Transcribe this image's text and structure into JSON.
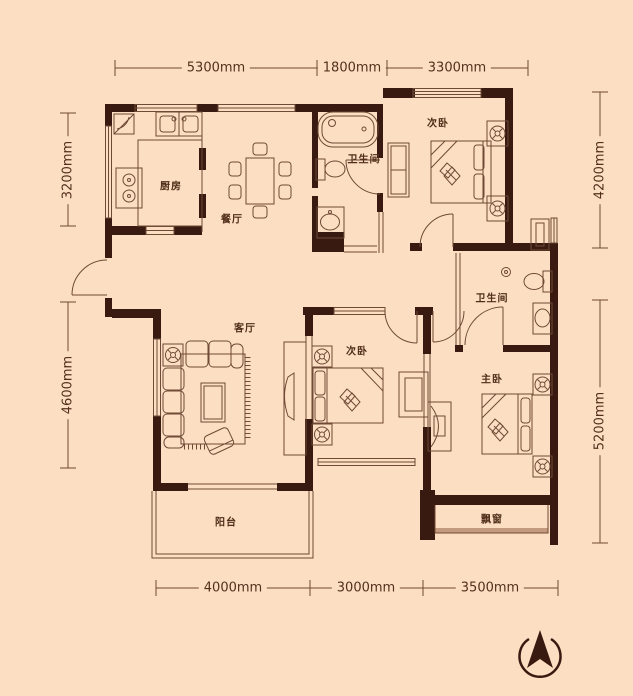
{
  "colors": {
    "background": "#fcdfc3",
    "wall": "#381a10",
    "line": "#6f4a36",
    "text": "#4f2d18",
    "sill": "#c49a7e"
  },
  "rooms": {
    "kitchen": {
      "label": "厨房"
    },
    "dining": {
      "label": "餐厅"
    },
    "bath_top": {
      "label": "卫生间"
    },
    "bedroom_top": {
      "label": "次卧"
    },
    "living": {
      "label": "客厅"
    },
    "bedroom_mid": {
      "label": "次卧"
    },
    "bath_right": {
      "label": "卫生间"
    },
    "master": {
      "label": "主卧"
    },
    "balcony": {
      "label": "阳台"
    },
    "bay_window": {
      "label": "飘窗"
    }
  },
  "dimensions": {
    "top": [
      {
        "label": "5300mm"
      },
      {
        "label": "1800mm"
      },
      {
        "label": "3300mm"
      }
    ],
    "bottom": [
      {
        "label": "4000mm"
      },
      {
        "label": "3000mm"
      },
      {
        "label": "3500mm"
      }
    ],
    "left": [
      {
        "label": "3200mm"
      },
      {
        "label": "4600mm"
      }
    ],
    "right": [
      {
        "label": "4200mm"
      },
      {
        "label": "5200mm"
      }
    ]
  },
  "icons": {
    "compass": "north-compass-icon"
  }
}
